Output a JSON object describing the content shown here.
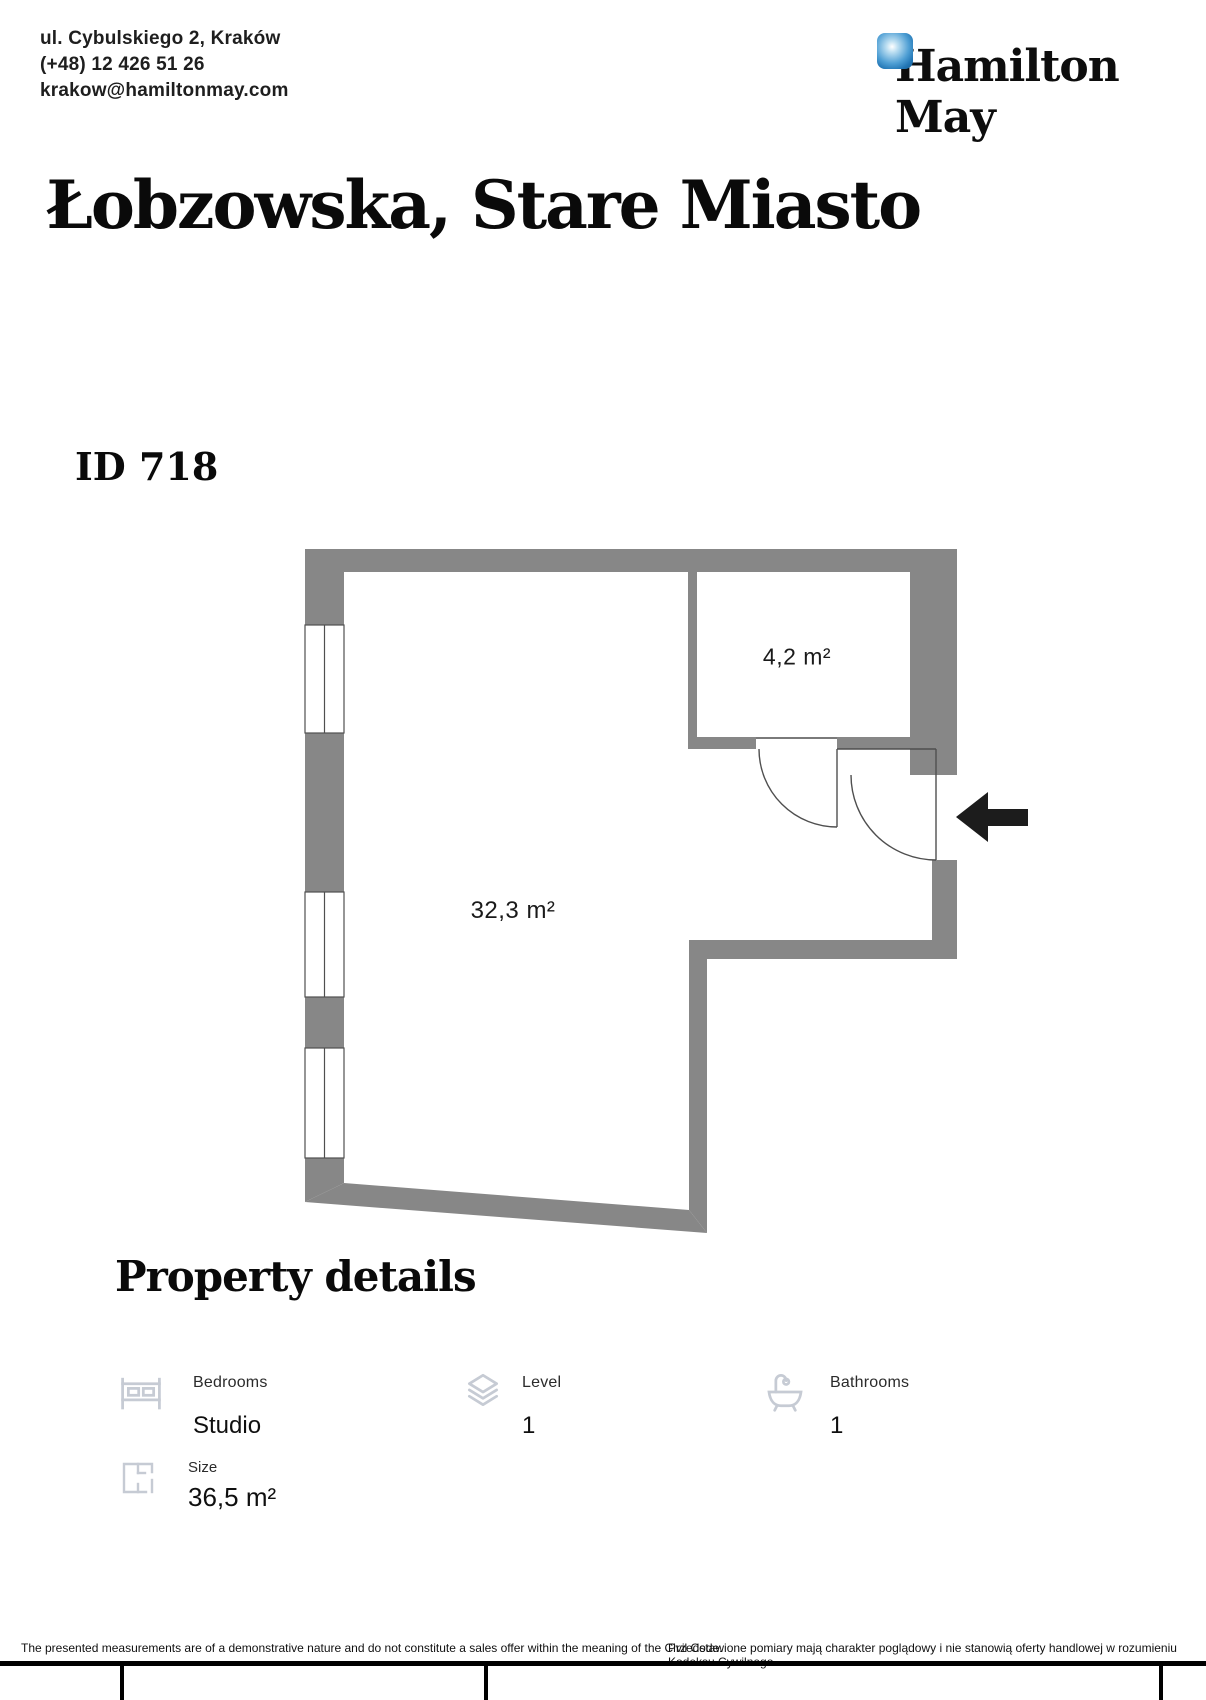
{
  "header": {
    "address": "ul. Cybulskiego 2, Kraków",
    "phone": "(+48) 12 426 51 26",
    "email": "krakow@hamiltonmay.com",
    "brand": "Hamilton May"
  },
  "listing": {
    "title": "Łobzowska, Stare Miasto",
    "id_label": "ID 718"
  },
  "floorplan": {
    "room_small_label": "4,2 m²",
    "room_main_label": "32,3 m²"
  },
  "property_details": {
    "heading": "Property details",
    "items": [
      {
        "icon": "bed-icon",
        "label": "Bedrooms",
        "value": "Studio"
      },
      {
        "icon": "layers-icon",
        "label": "Level",
        "value": "1"
      },
      {
        "icon": "bathtub-icon",
        "label": "Bathrooms",
        "value": "1"
      },
      {
        "icon": "floorplan-icon",
        "label": "Size",
        "value": "36,5 m²"
      }
    ]
  },
  "footer": {
    "disclaimer_en": "The presented measurements are of a demonstrative nature and do not constitute a sales offer within the meaning of the Civil Code.",
    "disclaimer_pl": "Przedstawione pomiary mają charakter poglądowy i nie stanowią oferty handlowej w rozumieniu Kodeksu Cywilnego."
  },
  "colors": {
    "wall_gray": "#878787",
    "plan_line": "#4f4f4f",
    "icon_gray": "#c6cbd4",
    "logo_blue": "#2276b5"
  }
}
